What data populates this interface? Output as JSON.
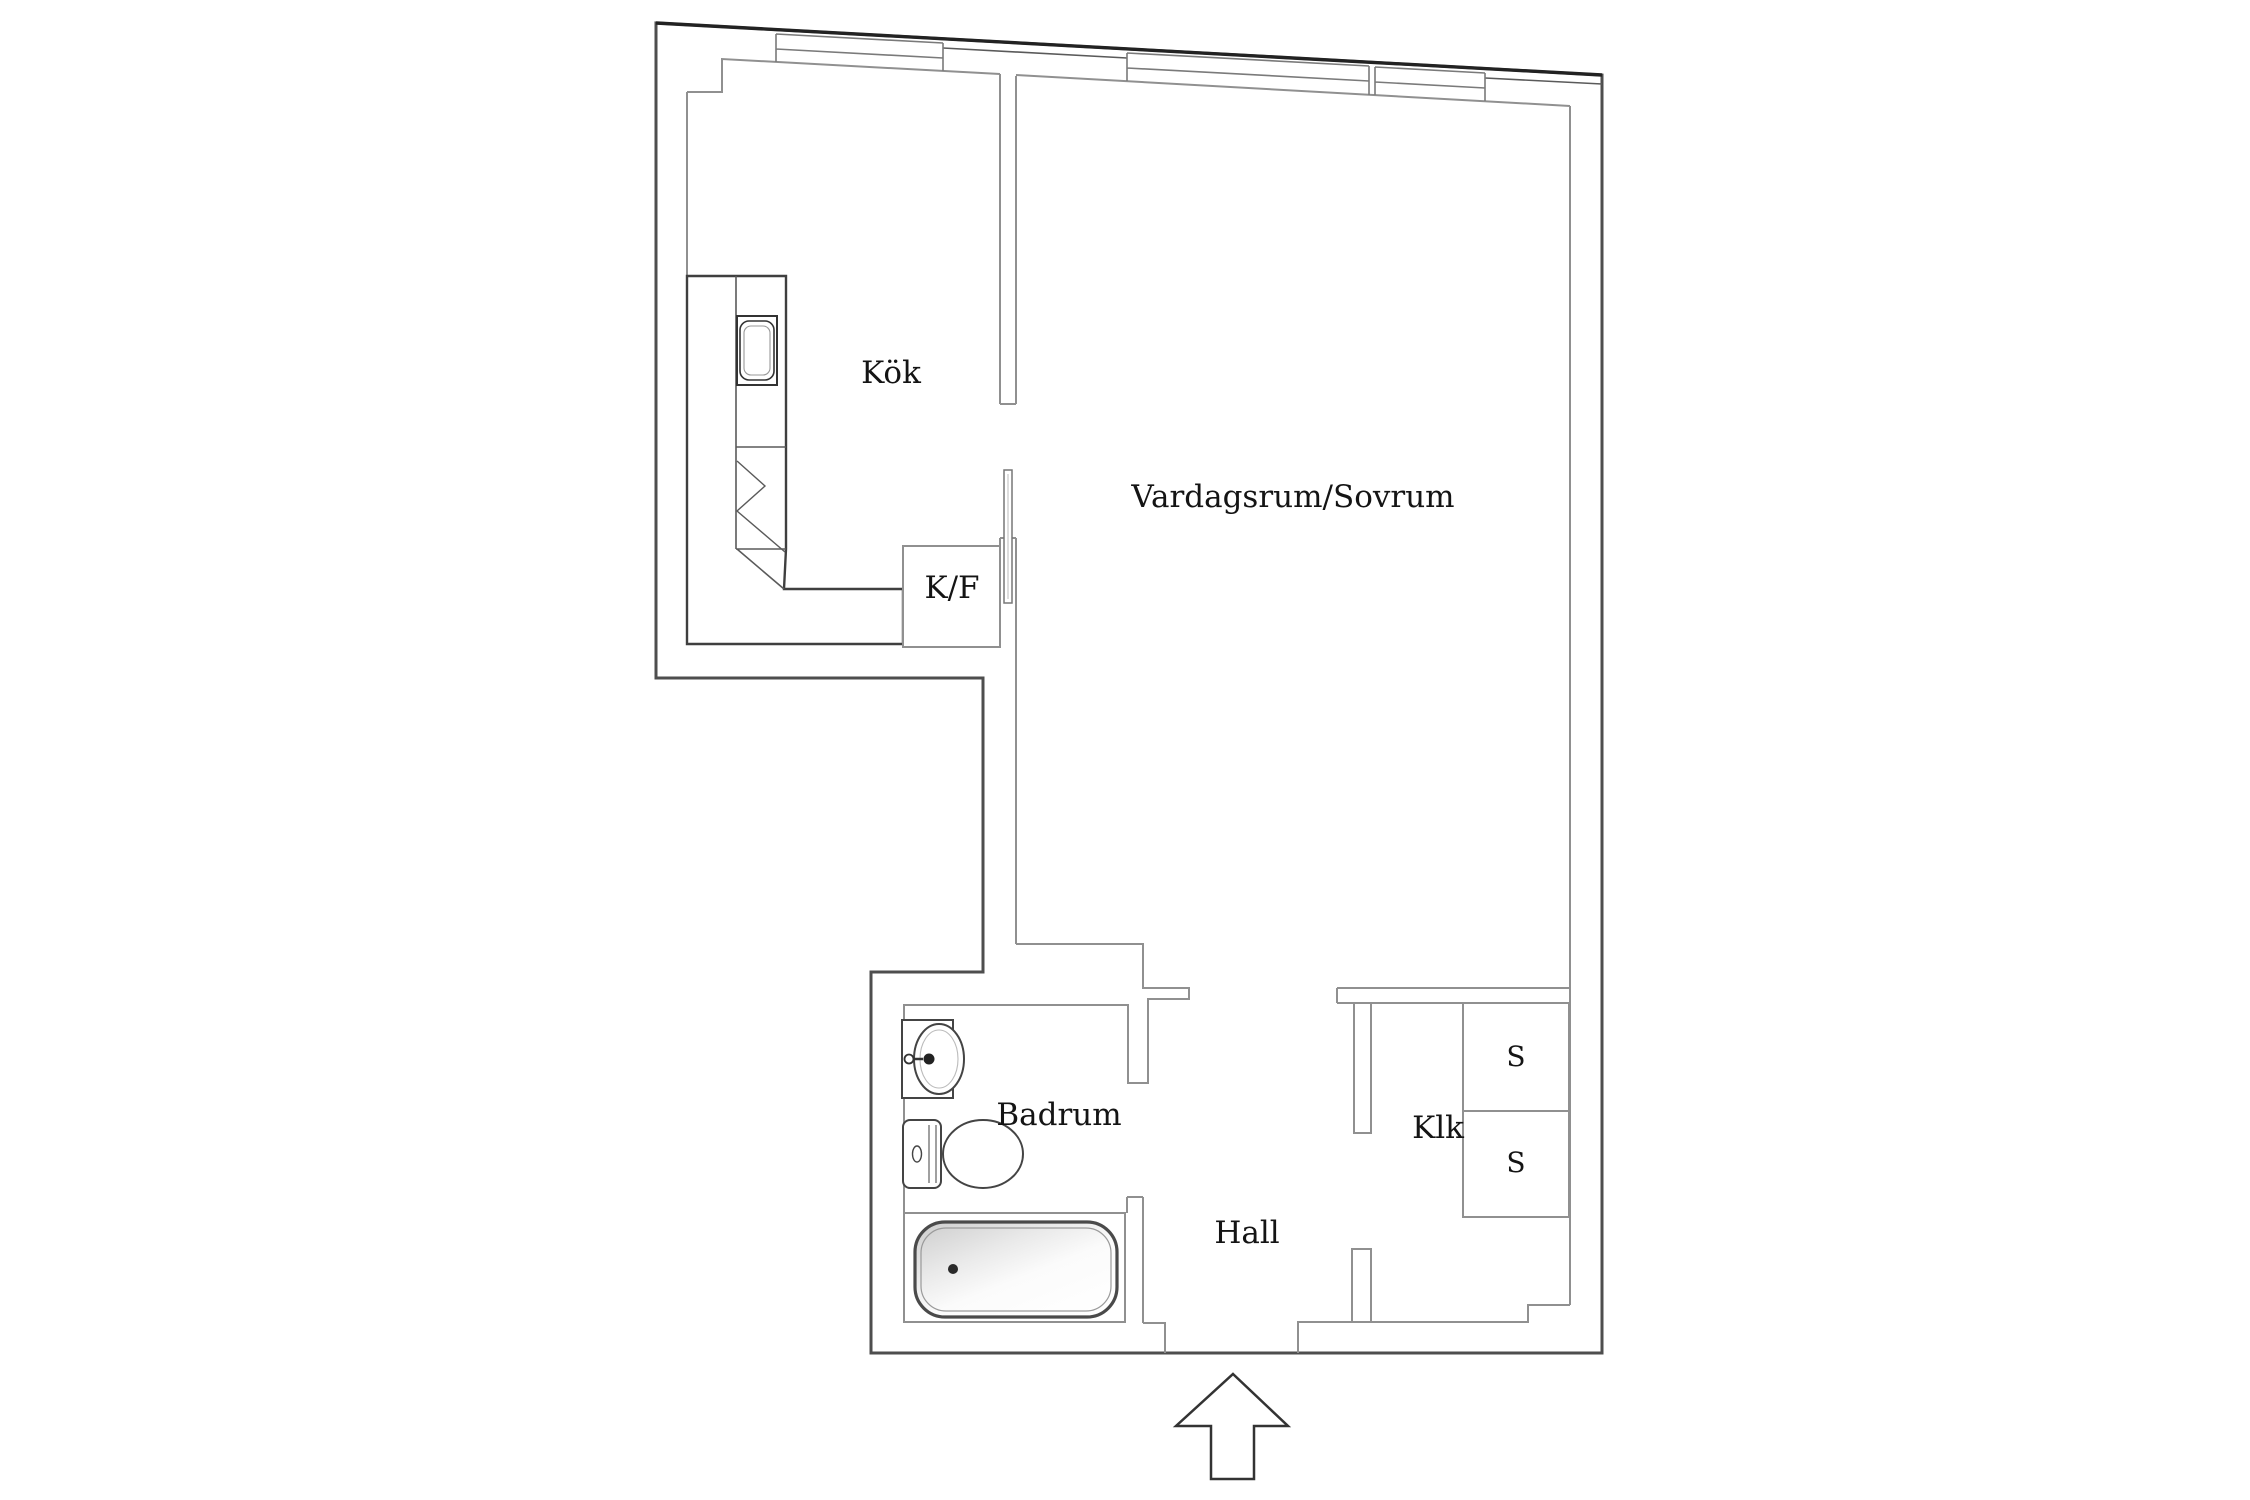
{
  "plan": {
    "type": "apartment-floor-plan",
    "rooms": {
      "kok": {
        "label": "Kök"
      },
      "living": {
        "label": "Vardagsrum/Sovrum"
      },
      "kf": {
        "label": "K/F"
      },
      "badrum": {
        "label": "Badrum"
      },
      "hall": {
        "label": "Hall"
      },
      "klk": {
        "label": "Klk"
      },
      "s_top": {
        "label": "S"
      },
      "s_bottom": {
        "label": "S"
      }
    },
    "icons": {
      "entry_arrow": "arrow-up-entrance"
    },
    "colors": {
      "background": "#ffffff",
      "outer_wall": "#4e4e4e",
      "top_wall": "#222222",
      "inner_wall": "#909090",
      "window_line": "#7a7a7a",
      "fixture_dark": "#3f3f3f",
      "fixture_light": "#9a9a9a",
      "tub_shade": "#d4d4d4",
      "label_text": "#141414"
    }
  }
}
